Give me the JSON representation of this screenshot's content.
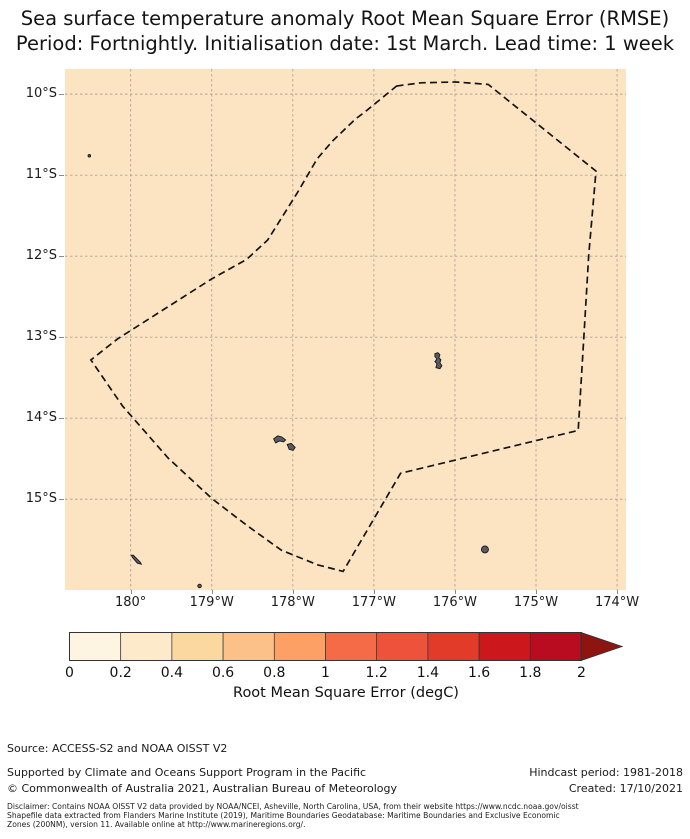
{
  "title": {
    "line1": "Sea surface temperature anomaly Root Mean Square Error (RMSE)",
    "line2": "Period: Fortnightly. Initialisation date: 1st March. Lead time: 1 week"
  },
  "map": {
    "ocean_color": "#fce4c3",
    "gridline_color": "#9b948b",
    "boundary_color": "#141414",
    "island_fill": "#5a5b60",
    "island_stroke": "#18181a",
    "x_tick_labels": [
      "180°",
      "179°W",
      "178°W",
      "177°W",
      "176°W",
      "175°W",
      "174°W"
    ],
    "y_tick_labels": [
      "10°S",
      "11°S",
      "12°S",
      "13°S",
      "14°S",
      "15°S"
    ],
    "lon_gridlines_degW": [
      180,
      179,
      178,
      177,
      176,
      175,
      174
    ],
    "lat_gridlines_degS": [
      10,
      11,
      12,
      13,
      14,
      15
    ],
    "extent": {
      "lonW_left": 180.81,
      "lonW_right": 173.89,
      "lat_top": 9.69,
      "lat_bottom": 16.12
    }
  },
  "chart_data": {
    "type": "heatmap",
    "title": "Sea surface temperature anomaly Root Mean Square Error (RMSE)",
    "subtitle": "Period: Fortnightly. Initialisation date: 1st March. Lead time: 1 week",
    "field": "SST anomaly RMSE (degC)",
    "field_appearance": "uniform single color bin over whole shown ocean area, approx 0.2-0.4 degC",
    "region": "Wallis and Futuna EEZ (dashed boundary), south-west Pacific",
    "axis": {
      "x_ticks_degrees": [
        "180°",
        "179°W",
        "178°W",
        "177°W",
        "176°W",
        "175°W",
        "174°W"
      ],
      "y_ticks_degrees": [
        "10°S",
        "11°S",
        "12°S",
        "13°S",
        "14°S",
        "15°S"
      ],
      "grid": true
    },
    "eez_boundary_lonW_latS": [
      [
        176.72,
        9.9
      ],
      [
        176.42,
        9.86
      ],
      [
        175.99,
        9.85
      ],
      [
        175.59,
        9.88
      ],
      [
        175.43,
        10.01
      ],
      [
        174.26,
        10.95
      ],
      [
        174.35,
        11.99
      ],
      [
        174.41,
        13.01
      ],
      [
        174.48,
        14.15
      ],
      [
        176.67,
        14.68
      ],
      [
        177.38,
        15.89
      ],
      [
        177.69,
        15.81
      ],
      [
        178.14,
        15.63
      ],
      [
        178.57,
        15.32
      ],
      [
        179.0,
        14.99
      ],
      [
        179.54,
        14.49
      ],
      [
        180.1,
        13.85
      ],
      [
        180.49,
        13.28
      ],
      [
        180.16,
        13.02
      ],
      [
        179.0,
        12.28
      ],
      [
        178.57,
        12.04
      ],
      [
        178.31,
        11.8
      ],
      [
        177.94,
        11.21
      ],
      [
        177.7,
        10.8
      ],
      [
        177.52,
        10.59
      ],
      [
        177.23,
        10.31
      ],
      [
        177.11,
        10.22
      ]
    ],
    "islands": [
      {
        "name": "wallis",
        "lonW": 176.21,
        "latS": 13.29,
        "shape": [
          [
            -3,
            -7
          ],
          [
            0,
            -8
          ],
          [
            2,
            -6
          ],
          [
            1,
            -3
          ],
          [
            3,
            -1
          ],
          [
            2,
            2
          ],
          [
            4,
            5
          ],
          [
            2,
            8
          ],
          [
            -2,
            7
          ],
          [
            -1,
            3
          ],
          [
            -3,
            1
          ],
          [
            -1,
            -2
          ],
          [
            -3,
            -4
          ]
        ]
      },
      {
        "name": "futuna",
        "lonW": 178.15,
        "latS": 14.28,
        "shape": [
          [
            -7,
            -2
          ],
          [
            -3,
            -5
          ],
          [
            1,
            -4
          ],
          [
            5,
            -1
          ],
          [
            3,
            1
          ],
          [
            -1,
            0
          ],
          [
            -5,
            2
          ]
        ]
      },
      {
        "name": "alofi",
        "lonW": 178.02,
        "latS": 14.36,
        "shape": [
          [
            -4,
            -3
          ],
          [
            0,
            -4
          ],
          [
            4,
            0
          ],
          [
            2,
            3
          ],
          [
            -2,
            2
          ]
        ]
      },
      {
        "name": "cikobia",
        "lonW": 179.93,
        "latS": 15.74,
        "shape": [
          [
            -5,
            -4
          ],
          [
            -3,
            -4
          ],
          [
            4,
            3
          ],
          [
            5,
            5
          ],
          [
            1,
            4
          ],
          [
            -4,
            -2
          ]
        ]
      },
      {
        "name": "niuafoou",
        "lonW": 175.63,
        "latS": 15.62,
        "r": 3.5
      },
      {
        "name": "niulakita",
        "lonW": 180.51,
        "latS": 10.76,
        "r": 1.3
      },
      {
        "name": "qelelevu",
        "lonW": 179.15,
        "latS": 16.07,
        "r": 1.8
      }
    ],
    "colorbar": {
      "range": [
        0,
        2
      ],
      "bin_width": 0.2,
      "ticks": [
        0,
        0.2,
        0.4,
        0.6,
        0.8,
        1,
        1.2,
        1.4,
        1.6,
        1.8,
        2
      ],
      "label": "Root Mean Square Error (degC)",
      "bin_colors": [
        "#fdf4e2",
        "#fdeaca",
        "#fcd8a1",
        "#fcc189",
        "#fca065",
        "#f56a47",
        "#ee523a",
        "#e23b2a",
        "#cc181c",
        "#b90c20"
      ],
      "over_arrow_color": "#8e1411",
      "outline_color": "#333333"
    }
  },
  "colorbar": {
    "tick_labels": [
      "0",
      "0.2",
      "0.4",
      "0.6",
      "0.8",
      "1",
      "1.2",
      "1.4",
      "1.6",
      "1.8",
      "2"
    ],
    "label": "Root Mean Square Error (degC)"
  },
  "footer": {
    "source": "Source: ACCESS-S2 and NOAA OISST V2",
    "supported": "Supported by Climate and Oceans Support Program in the Pacific",
    "copyright": "© Commonwealth of Australia 2021, Australian Bureau of Meteorology",
    "hindcast": "Hindcast period: 1981-2018",
    "created": "Created: 17/10/2021",
    "disclaimer_line1": "Disclaimer: Contains NOAA OISST V2 data provided by NOAA/NCEI, Asheville, North Carolina, USA, from their website https://www.ncdc.noaa.gov/oisst",
    "disclaimer_line2": "Shapefile data extracted from Flanders Marine Institute (2019), Maritime Boundaries Geodatabase: Maritime Boundaries and Exclusive Economic",
    "disclaimer_line3": "Zones (200NM), version 11. Available online at http://www.marineregions.org/."
  }
}
